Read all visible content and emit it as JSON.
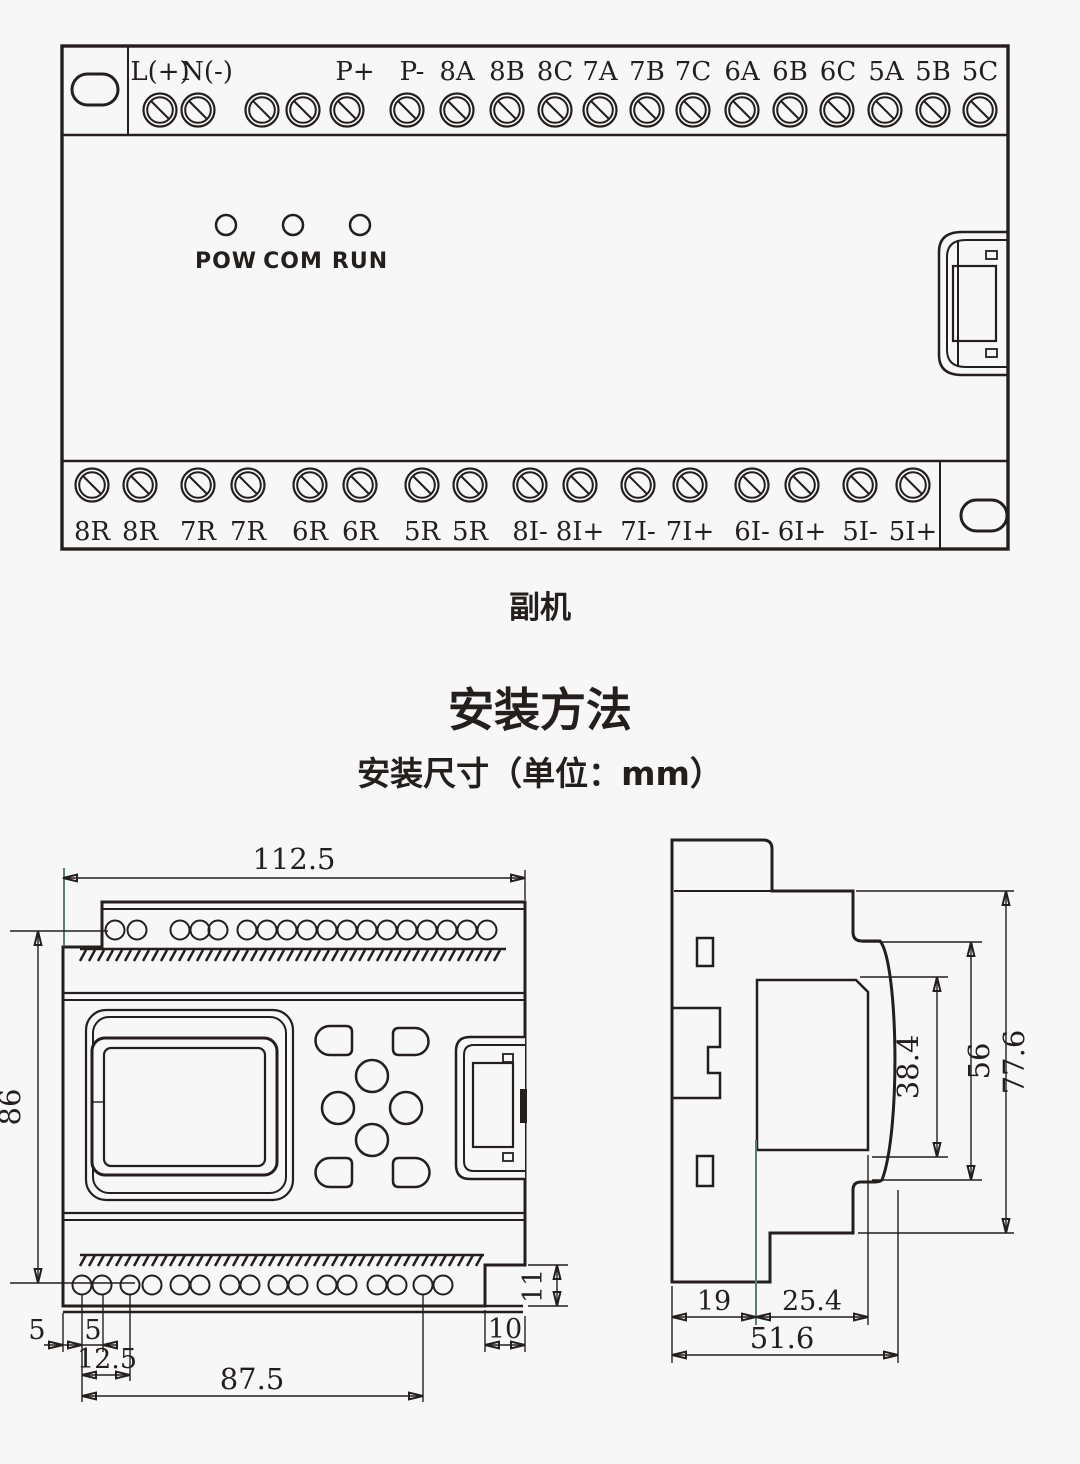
{
  "module": {
    "caption": "副机",
    "leds": [
      "POW",
      "COM",
      "RUN"
    ],
    "top_terminals": [
      "L(+)",
      "N(-)",
      "P+",
      "P-",
      "8A",
      "8B",
      "8C",
      "7A",
      "7B",
      "7C",
      "6A",
      "6B",
      "6C",
      "5A",
      "5B",
      "5C"
    ],
    "bottom_terminals": [
      "8R",
      "8R",
      "7R",
      "7R",
      "6R",
      "6R",
      "5R",
      "5R",
      "8I-",
      "8I+",
      "7I-",
      "7I+",
      "6I-",
      "6I+",
      "5I-",
      "5I+"
    ]
  },
  "section": {
    "title": "安装方法",
    "subtitle": "安装尺寸（单位：mm）"
  },
  "dims": {
    "front": {
      "width": "112.5",
      "height": "86",
      "edge_to_hole": "5",
      "hole_pitch": "5",
      "first_group": "12.5",
      "hole_span": "87.5",
      "notch_w": "10",
      "notch_h": "11"
    },
    "side": {
      "front_depth": "38.4",
      "body_depth": "56",
      "total_depth": "77.6",
      "seg_left": "19",
      "seg_mid": "25.4",
      "base_width": "51.6"
    }
  },
  "colors": {
    "line": "#241f1d",
    "extension_accent": "#5a7d7c",
    "background": "#f7f7f7"
  }
}
